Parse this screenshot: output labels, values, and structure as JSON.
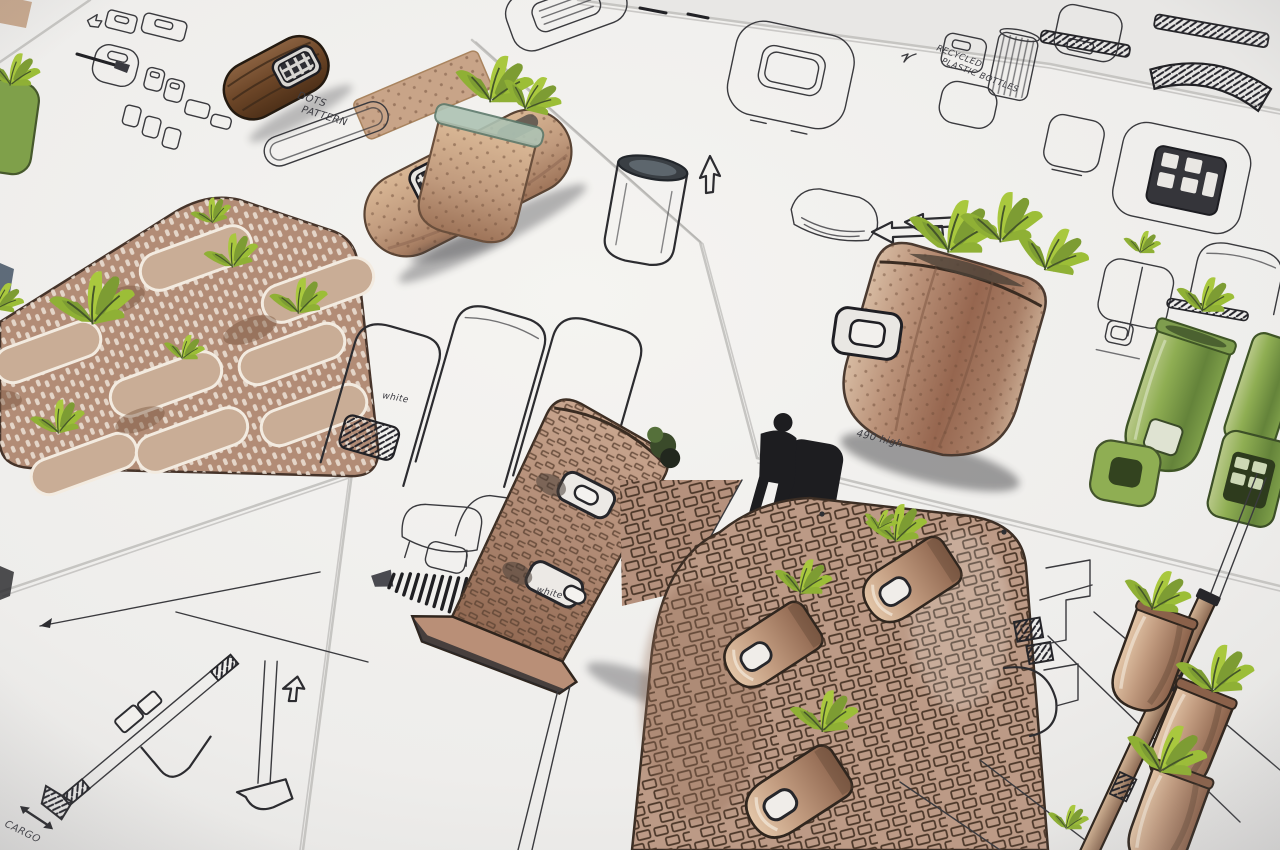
{
  "scene": {
    "type": "photograph",
    "subject": "Industrial design marker sketches of planters, vertical garden panels and pole-mounted plant pots drawn on overlapping white paper sheets",
    "annotations": {
      "dots_line1": "DOTS",
      "dots_line2": "PATTERN",
      "recycled_line1": "RECYCLED",
      "recycled_line2": "PLASTIC BOTTLES",
      "white_grille_label": "white",
      "white_signature": "white",
      "height_note": "490 high",
      "cargo_label": "CARGO"
    },
    "palette": {
      "paper": "#f0efec",
      "ink": "#2c2c30",
      "marker_tan": "#c09a7d",
      "marker_brown": "#a87f69",
      "marker_dark_brown": "#6b4527",
      "leaf_green_bright": "#a9c83e",
      "leaf_green_dark": "#7d9c33",
      "pot_green": "#8fae53",
      "figure_black": "#1d1d20",
      "shadow": "#35353b"
    }
  }
}
